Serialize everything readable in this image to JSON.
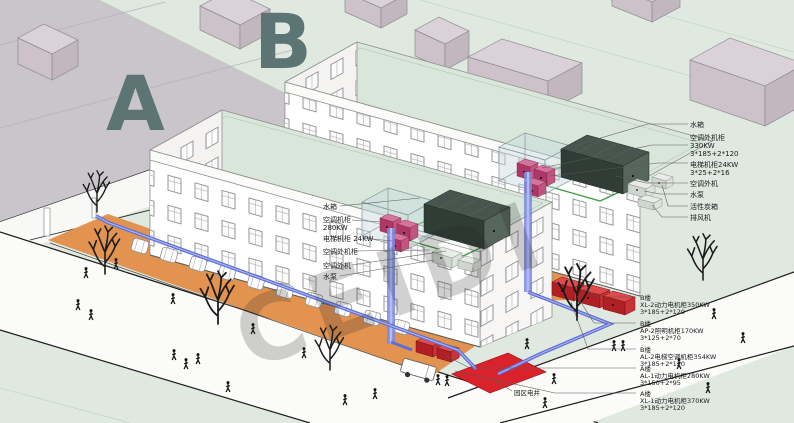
{
  "markers": {
    "a": "A",
    "b": "B"
  },
  "watermark": "CEIDI",
  "roof_labels_a": {
    "water_tank": "水箱",
    "ac_cabinet_line1": "空调机柜",
    "ac_cabinet_line2": "280KW",
    "elevator_cabinet": "电梯机柜 24KW",
    "ac_outdoor_cabinet": "空调外机柜",
    "ac_outdoor_unit": "空调外机",
    "water_pump": "水泵"
  },
  "roof_labels_b": {
    "water_tank": "水箱",
    "ac_outdoor_cabinet_line1": "空调外机柜",
    "ac_outdoor_cabinet_line2": "330KW",
    "ac_outdoor_cabinet_line3": "3*185+2*120",
    "elevator_cabinet_line1": "电梯机柜24KW",
    "elevator_cabinet_line2": "3*25+2*16",
    "ac_outdoor_unit": "空调外机",
    "water_pump": "水泵",
    "activated_carbon_box": "活性炭箱",
    "exhaust_fan": "排风机"
  },
  "power_cabinet_labels": [
    {
      "building": "B楼",
      "name": "XL-2动力电机柜350KW",
      "spec": "3*185+2*120"
    },
    {
      "building": "B楼",
      "name": "AP-2照明机柜170KW",
      "spec": "3*125+2*70"
    },
    {
      "building": "B楼",
      "name": "AL-2电梯空调机柜354KW",
      "spec": "3*185+2*120"
    },
    {
      "building": "A楼",
      "name": "AL-1动力电机柜280KW",
      "spec": "3*150+2*95"
    },
    {
      "building": "A楼",
      "name": "XL-1动力电机柜370KW",
      "spec": "3*185+2*120"
    }
  ],
  "site_labels": {
    "campus_electric_shaft": "园区电井"
  },
  "colors": {
    "ground_green": "#dfe9e0",
    "plaza_gray": "#cac5ca",
    "roof_green": "#d9e7da",
    "parking_orange": "#e29350",
    "pipe_blue": "#5d6fd6",
    "pipe_green": "#3f9f42",
    "shaft_red": "#d9222a",
    "cabinet_pink": "#c25580",
    "context_mauve": "#d5cbd2",
    "letter_gray": "#5d7474"
  }
}
